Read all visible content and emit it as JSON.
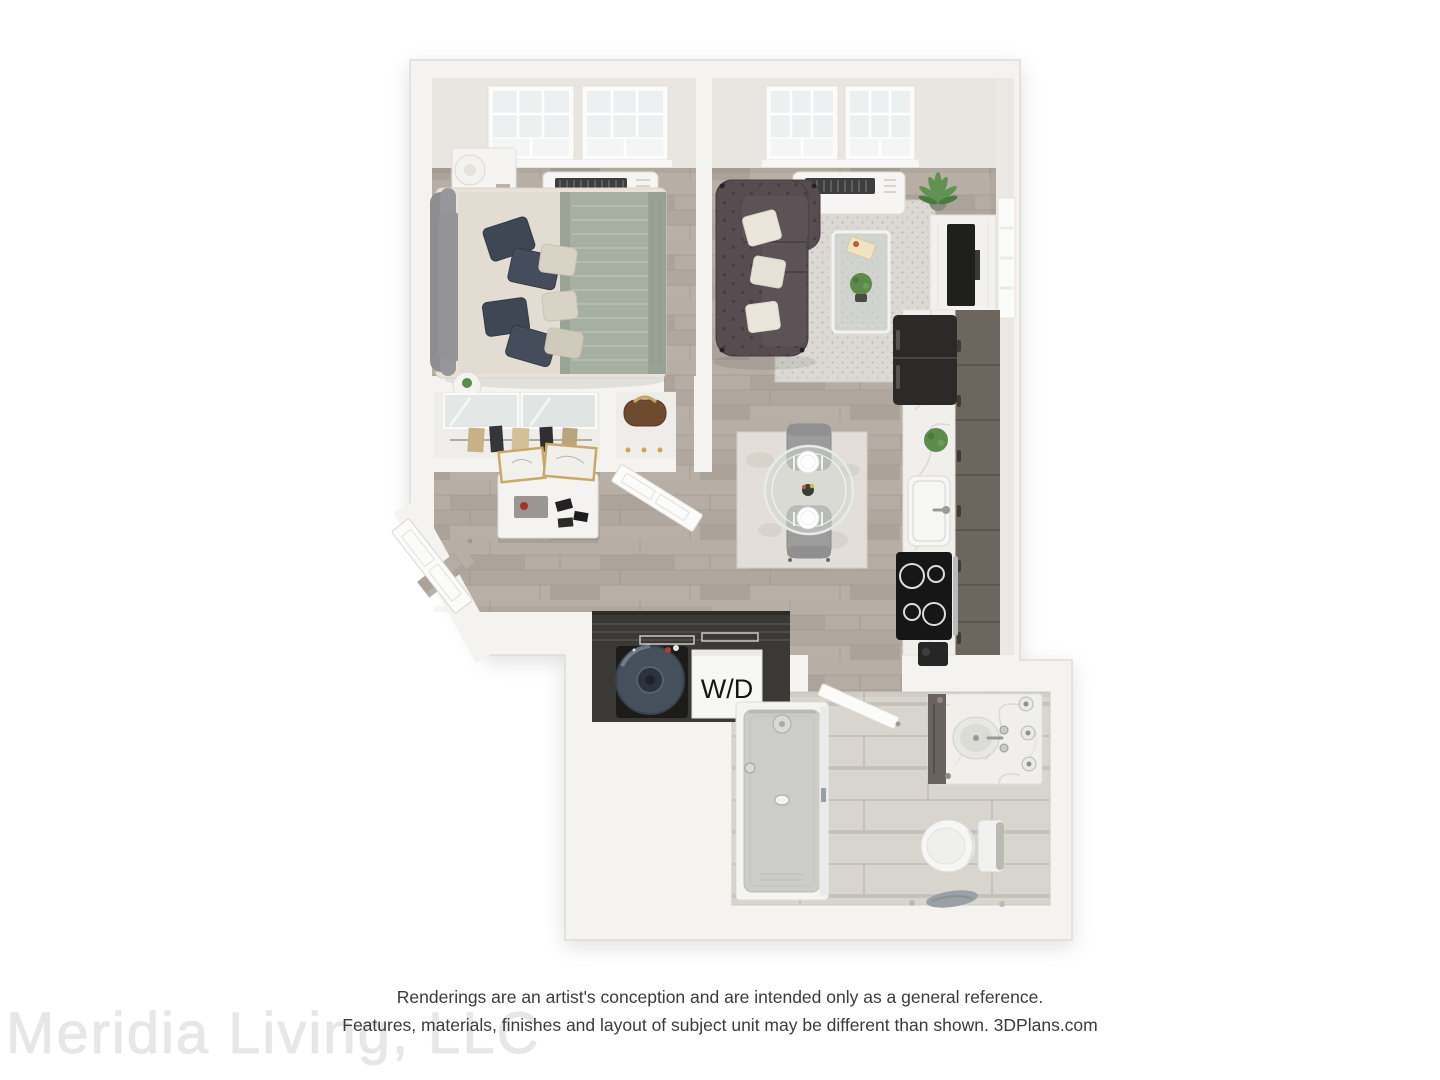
{
  "floorplan": {
    "wd_label": "W/D"
  },
  "footer": {
    "watermark": "Meridia Living, LLC",
    "disclaimer_line1": "Renderings are an artist's conception and are intended only as a general reference.",
    "disclaimer_line2": "Features, materials, finishes and layout of subject unit may be different than shown. 3DPlans.com"
  },
  "colors": {
    "background": "#ffffff",
    "wall": "#f4f3f0",
    "wall_face": "#e9e6e1",
    "wood_floor": "#b3aaa1",
    "bath_tile": "#d8d4ce",
    "sofa": "#574d51",
    "kitchen_cabinet": "#6d665f",
    "bed_blanket": "#a5b0a2",
    "pillow_navy": "#3f4654",
    "water_heater": "#46505d",
    "plant_green": "#5d8b4b",
    "appliance_black": "#1f1f1e",
    "disclaimer_text": "#3b3b3b",
    "watermark_text": "#e7e7e7",
    "wd_text": "#151515"
  }
}
